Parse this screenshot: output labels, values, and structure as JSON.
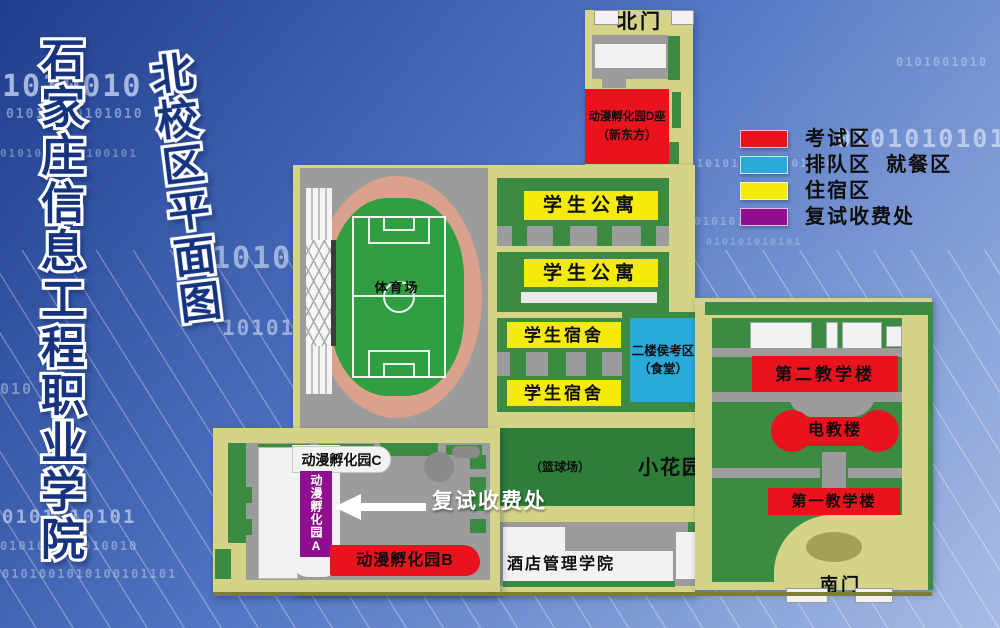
{
  "titles": {
    "school": "石家庄信息工程职业学院",
    "map": "北校区平面图"
  },
  "legend": [
    {
      "label": "考试区"
    },
    {
      "label": "排队区  就餐区"
    },
    {
      "label": "住宿区"
    },
    {
      "label": "复试收费处"
    }
  ],
  "map": {
    "north_gate": "北门",
    "south_gate": "南门",
    "incubator_d_line1": "动漫孵化园D座",
    "incubator_d_line2": "（新东方）",
    "apartment": "学生公寓",
    "apartment2": "学生公寓",
    "dorm": "学生宿舍",
    "dorm2": "学生宿舍",
    "waiting_line1": "二楼侯考区",
    "waiting_line2": "（食堂）",
    "stadium": "体育场",
    "teaching2": "第二教学楼",
    "av_building": "电教楼",
    "teaching1": "第一教学楼",
    "basketball": "（篮球场）",
    "garden": "小花园",
    "hotel_college": "酒店管理学院",
    "incubator_c": "动漫孵化园C",
    "incubator_a": "动漫孵化园A",
    "incubator_b": "动漫孵化园B",
    "fee_office_arrow": "复试收费处"
  },
  "background": {
    "binary": [
      "1010010",
      "01010010101010",
      "0101001010100101",
      "1010",
      "10101010",
      "010",
      "0101010101",
      "010100101010010",
      "0101001010100101101",
      "0101010101",
      "01010101010101010",
      "0101001010",
      "0101010101",
      "010101010101"
    ]
  },
  "colors": {
    "exam": "#e8131d",
    "queue": "#2aa9db",
    "housing": "#f4eb0d",
    "fee": "#8f0f90",
    "base": "#d5d388",
    "green": "#3b8b43",
    "ggreen": "#2e7d39",
    "road": "#9c9c9c",
    "track": "#daa18c",
    "field": "#2f9f41",
    "white": "#f2f2f2",
    "sky1": "#203f8e",
    "sky2": "#5377c4",
    "sky3": "#a7bbe4"
  }
}
